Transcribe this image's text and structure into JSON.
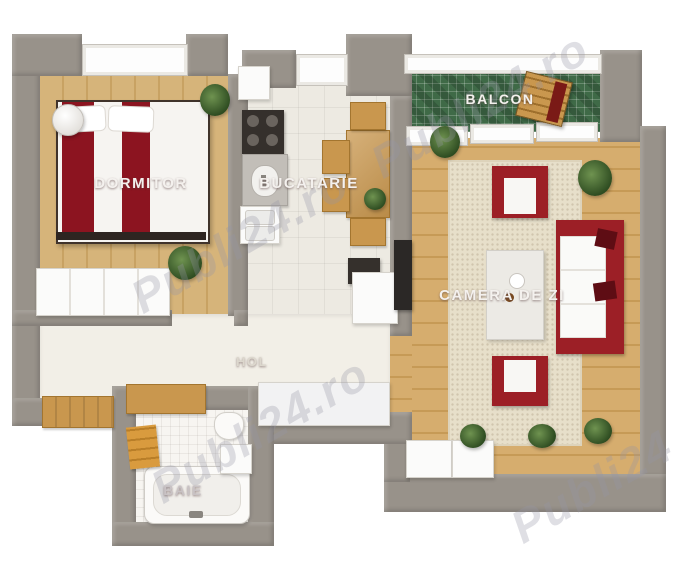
{
  "title": "3D apartment floor plan",
  "watermark": {
    "text": "Publi24.ro",
    "color": "#9496a6"
  },
  "rooms": [
    {
      "id": "dormitor",
      "label": "DORMITOR"
    },
    {
      "id": "bucatarie",
      "label": "BUCATARIE"
    },
    {
      "id": "balcon",
      "label": "BALCON"
    },
    {
      "id": "camera_de_zi",
      "label": "CAMERA DE ZI"
    },
    {
      "id": "hol",
      "label": "HOL"
    },
    {
      "id": "baie",
      "label": "BAIE"
    }
  ],
  "colors": {
    "wall": "#98928a",
    "bedroom_floor_wood": "#d6b47a",
    "living_floor_wood": "#d6ad6e",
    "kitchen_floor": "#edeae2",
    "hall_floor": "#f2efe7",
    "bath_floor": "#f7f5f1",
    "balcony_mosaic_green": "#3f6a47",
    "sofa_red": "#9c1f26",
    "bed_red": "#8c1420",
    "wood_furniture": "#c9974e",
    "rug": "#e7dfca",
    "label_text": "#f4f1ee",
    "background": "#ffffff"
  }
}
